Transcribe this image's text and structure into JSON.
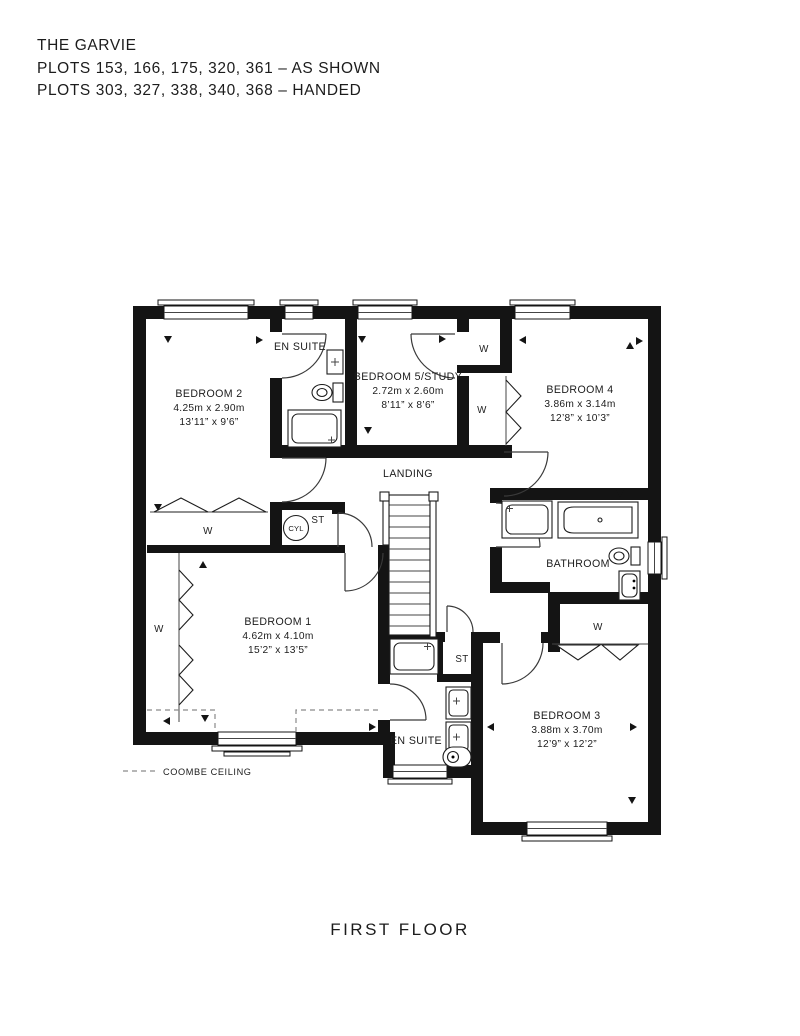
{
  "header": {
    "title": "THE GARVIE",
    "line1": "PLOTS 153, 166, 175, 320, 361 – AS SHOWN",
    "line2": "PLOTS 303, 327, 338, 340, 368 – HANDED",
    "accent_color": "#B6955C"
  },
  "rooms": {
    "bedroom2": {
      "name": "BEDROOM 2",
      "metric": "4.25m x 2.90m",
      "imperial": "13’11” x 9’6”"
    },
    "ensuite_top": {
      "name": "EN SUITE"
    },
    "bedroom5": {
      "name": "BEDROOM 5/STUDY",
      "metric": "2.72m x 2.60m",
      "imperial": "8’11” x 8’6”"
    },
    "bedroom4": {
      "name": "BEDROOM 4",
      "metric": "3.86m x 3.14m",
      "imperial": "12’8” x 10’3”"
    },
    "landing": {
      "name": "LANDING"
    },
    "bathroom": {
      "name": "BATHROOM"
    },
    "bedroom1": {
      "name": "BEDROOM 1",
      "metric": "4.62m x 4.10m",
      "imperial": "15’2” x 13’5”"
    },
    "ensuite_bottom": {
      "name": "EN SUITE"
    },
    "bedroom3": {
      "name": "BEDROOM 3",
      "metric": "3.88m x 3.70m",
      "imperial": "12’9” x 12’2”"
    }
  },
  "labels": {
    "wardrobe": "W",
    "store": "ST",
    "cylinder": "CYL"
  },
  "legend": {
    "coombe": "COOMBE CEILING"
  },
  "footer": {
    "floor_label": "FIRST FLOOR"
  }
}
